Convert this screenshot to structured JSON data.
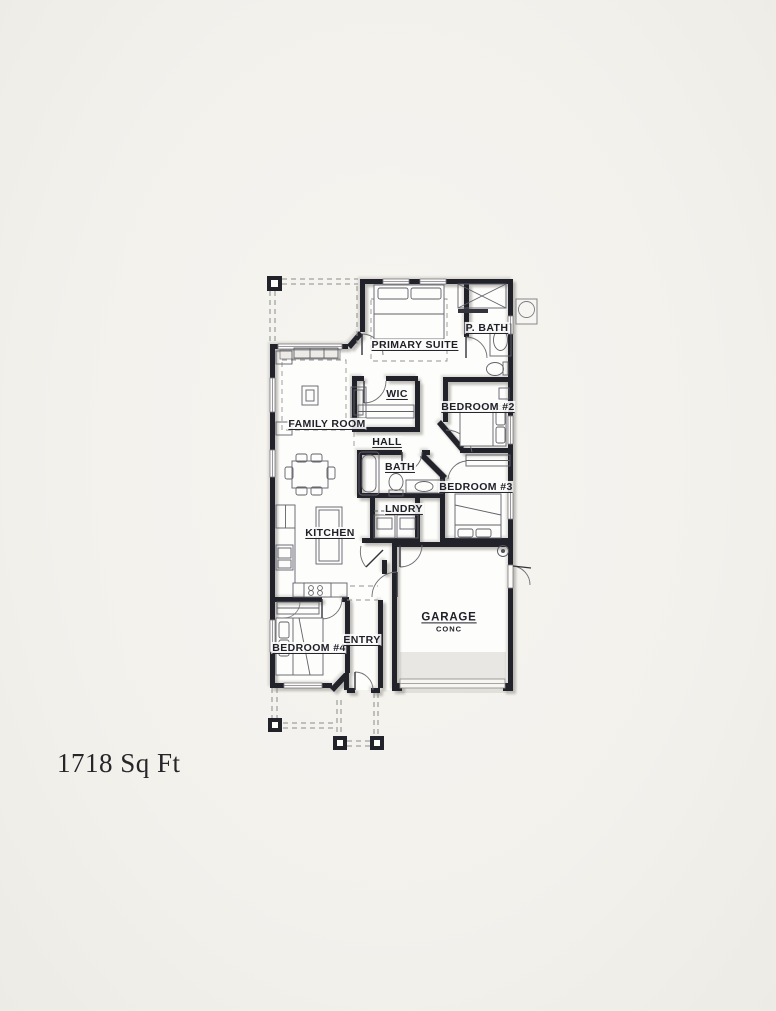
{
  "plan": {
    "area_text": "1718 Sq Ft",
    "labels": {
      "primary_suite": "PRIMARY SUITE",
      "p_bath": "P. BATH",
      "wic": "WIC",
      "bedroom_2": "BEDROOM #2",
      "family_room": "FAMILY ROOM",
      "hall": "HALL",
      "bath": "BATH",
      "bedroom_3": "BEDROOM #3",
      "kitchen": "KITCHEN",
      "laundry": "LNDRY",
      "bedroom_4": "BEDROOM #4",
      "entry": "ENTRY",
      "garage": "GARAGE",
      "garage_floor": "CONC"
    },
    "colors": {
      "paper": "#f4f2ed",
      "floor": "#fdfdfb",
      "wall": "#22222a",
      "shadow": "#cfccc6",
      "fixture": "#61616a",
      "dash": "#96948f"
    }
  }
}
